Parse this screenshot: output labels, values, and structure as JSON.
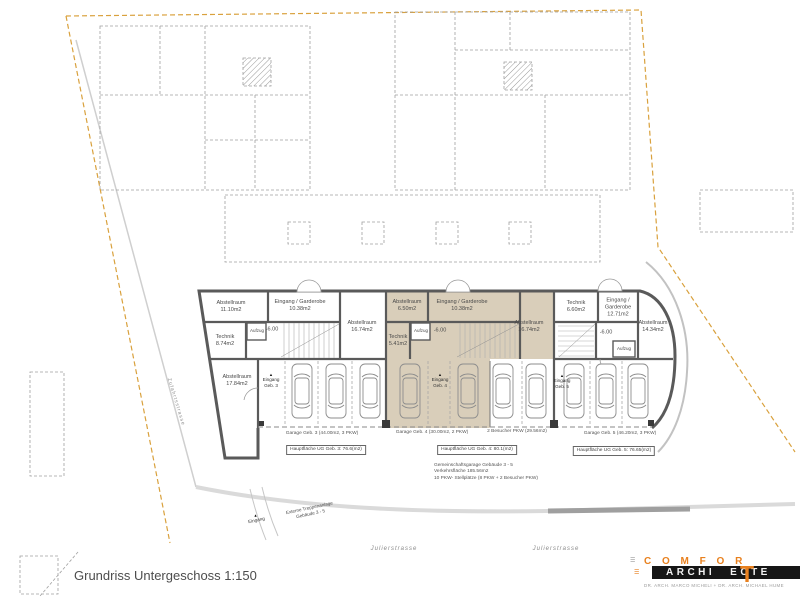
{
  "title": "Grundriss Untergeschoss 1:150",
  "colors": {
    "accent_tan": "#d9ceba",
    "wall_gray": "#5a5a5a",
    "boundary_orange": "#d9a13d",
    "logo_orange": "#e8801e"
  },
  "icons": {
    "entry_marker": "▲",
    "menu_lines": "☰"
  },
  "site": {
    "street1": "Julierstrasse",
    "street2": "Julierstrasse",
    "access_road": "Zufahrtsstrasse",
    "entrance": "Eingang",
    "external_stair_line1": "Externe Treppenanlage",
    "external_stair_line2": "Gebäude 3 - 5"
  },
  "garage_summary": {
    "line1": "Gemeinschaftsgarage Gebäude 3 - 5",
    "line2": "Verkehrsfläche 185.56m2",
    "line3": "10 PKW- Stellplätze (8 PKW + 2 Besucher PKW)"
  },
  "b3": {
    "abstell1_name": "Abstellraum",
    "abstell1_area": "11.10m2",
    "garderobe_name": "Eingang / Garderobe",
    "garderobe_area": "10.38m2",
    "abstell2_name": "Abstellraum",
    "abstell2_area": "16.74m2",
    "technik_name": "Technik",
    "technik_area": "8.74m2",
    "abstell3_name": "Abstellraum",
    "abstell3_area": "17.84m2",
    "aufzug": "Aufzug",
    "level": "-6.00",
    "entry_line1": "Eingang",
    "entry_line2": "Geb. 3",
    "garage_label": "Garage Geb. 3 (44.00m2, 3 PKW)",
    "hauptflaeche": "Hauptfläche UG Geb. 3: 76.6(m2)"
  },
  "b4": {
    "abstell1_name": "Abstellraum",
    "abstell1_area": "6.50m2",
    "garderobe_name": "Eingang / Garderobe",
    "garderobe_area": "10.38m2",
    "abstell2_name": "Abstellraum",
    "abstell2_area": "16.74m2",
    "technik_name": "Technik",
    "technik_area": "5.41m2",
    "aufzug": "Aufzug",
    "level": "-6.00",
    "entry_line1": "Eingang",
    "entry_line2": "Geb. 4",
    "garage_label": "Garage Geb. 4 (30.00m2, 2 PKW)",
    "besucher_label": "2 Besucher PKW (29.56m2)",
    "hauptflaeche": "Hauptfläche UG Geb. 4: 80.1(m2)"
  },
  "b5": {
    "technik_name": "Technik",
    "technik_area": "6.60m2",
    "garderobe_name": "Eingang / Garderobe",
    "garderobe_area": "12.71m2",
    "abstell_name": "Abstellraum",
    "abstell_area": "14.34m2",
    "aufzug": "Aufzug",
    "level": "-6.00",
    "entry_line1": "Eingang",
    "entry_line2": "Geb. 5",
    "garage_label": "Garage Geb. 5 (46.20m2, 3 PKW)",
    "hauptflaeche": "Hauptfläche UG Geb. 5: 76.65(m2)"
  },
  "logo": {
    "word_top": "C O M F O R",
    "big_t": "T",
    "word_bar_left": "ARCHI",
    "word_bar_right": "ECTE",
    "tagline": "DR. ARCH. MARCO MICHELI  +  DR. ARCH. MICHAEL HUME"
  }
}
